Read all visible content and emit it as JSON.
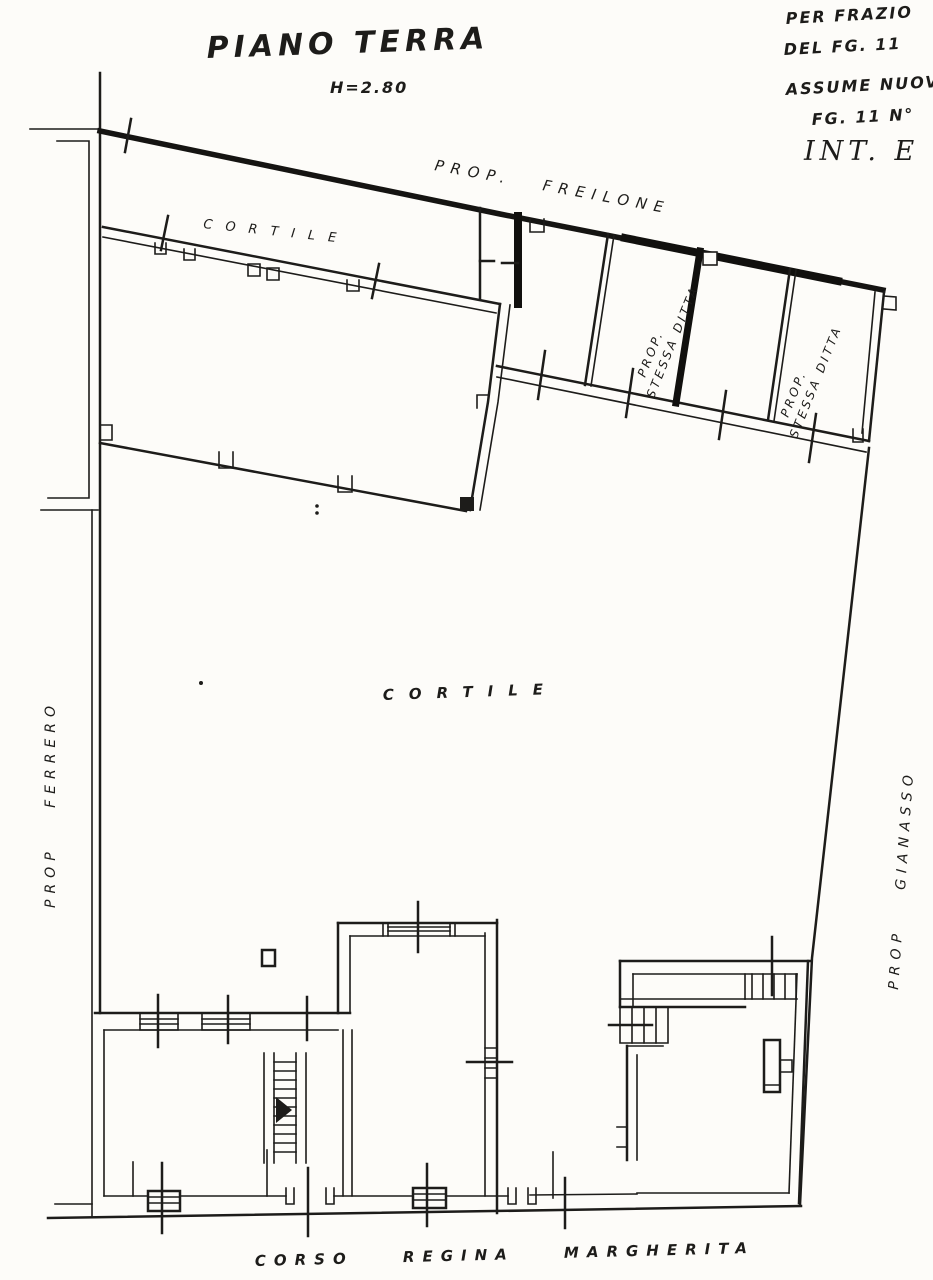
{
  "meta": {
    "paper_color": "#fdfcf9",
    "ink_color": "#1d1c1a"
  },
  "titleblock": {
    "title": "PIANO TERRA",
    "height_note": "H=2.80"
  },
  "annotations": {
    "note_line_1": "PER FRAZIO",
    "note_line_2": "DEL FG. 11",
    "note_line_3": "ASSUME NUOV",
    "note_line_4": "FG. 11 N°",
    "interno_label": "INT. E"
  },
  "plan_labels": {
    "north_boundary_owner": "PROP. FREILONE",
    "upper_courtyard": "CORTILE",
    "main_courtyard": "CORTILE",
    "west_owner": "PROP FERRERO",
    "east_owner": "PROP GIANASSO",
    "same_owner_room_1_line1": "PROP.",
    "same_owner_room_1_line2": "STESSA DITTA",
    "same_owner_room_2_line1": "PROP.",
    "same_owner_room_2_line2": "STESSA DITTA",
    "street": "CORSO REGINA MARGHERITA"
  }
}
